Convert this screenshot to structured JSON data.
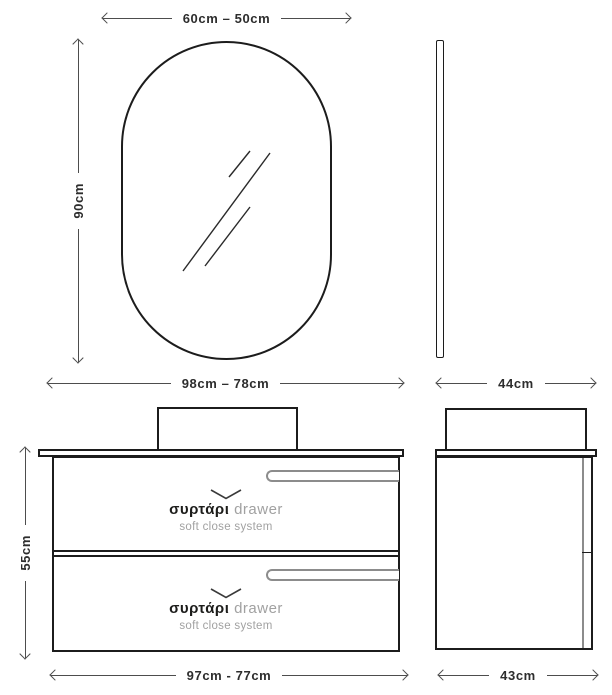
{
  "diagram_title": "vanity-and-mirror-dimension-diagram",
  "palette": {
    "background": "#ffffff",
    "outline": "#1c1c1c",
    "dim_line": "#4d4d4d",
    "dim_text": "#2d2d2d",
    "handle_gray": "#8c8c8c",
    "gray_text": "#a1a1a1"
  },
  "dimensions": {
    "mirror_width": "60cm – 50cm",
    "mirror_height": "90cm",
    "vanity_top_width": "98cm – 78cm",
    "mirror_side_depth": "44cm",
    "vanity_height": "55cm",
    "vanity_bottom_width": "97cm - 77cm",
    "vanity_side_depth": "43cm"
  },
  "drawers": [
    {
      "label_gr": "συρτάρι",
      "label_en": "drawer",
      "subtitle": "soft close system"
    },
    {
      "label_gr": "συρτάρι",
      "label_en": "drawer",
      "subtitle": "soft close system"
    }
  ],
  "icons": {
    "chevron": "chevron-down",
    "arrows": "double-headed-dimension-arrow"
  }
}
